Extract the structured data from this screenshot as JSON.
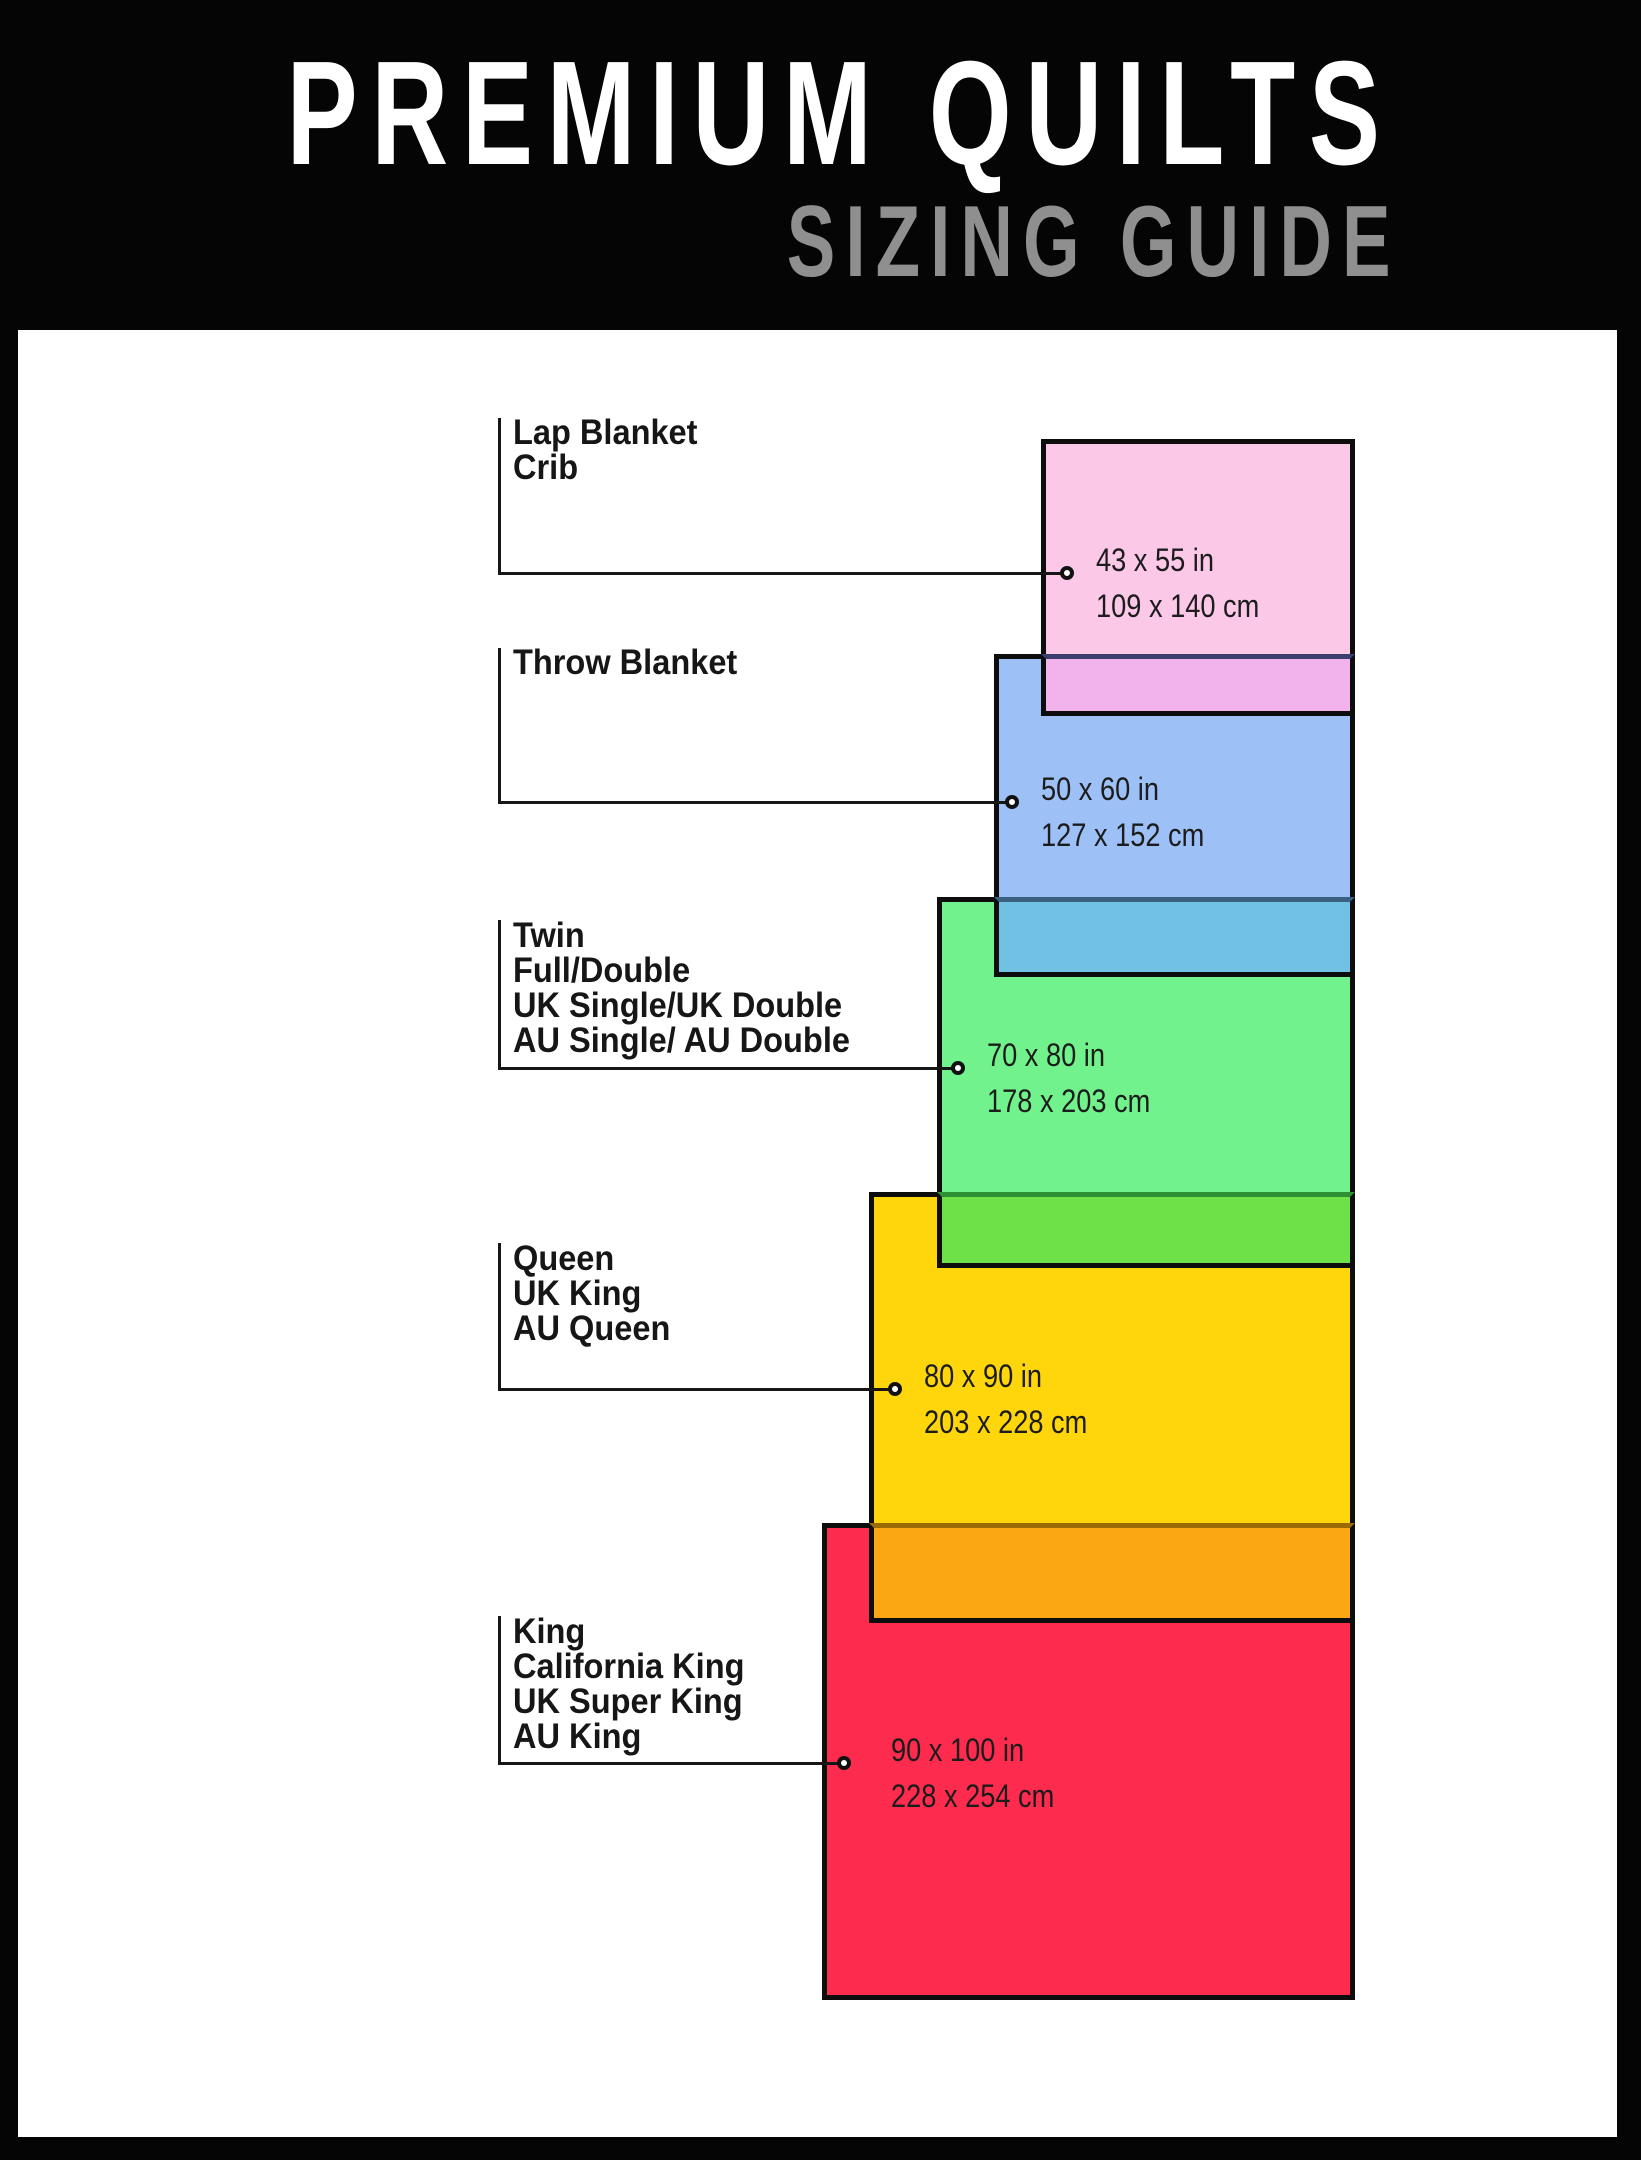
{
  "header": {
    "title": "PREMIUM QUILTS",
    "subtitle": "SIZING GUIDE",
    "background": "#050505",
    "title_color": "#ffffff",
    "subtitle_color": "#8f8f8f"
  },
  "canvas": {
    "background": "#ffffff",
    "border_color": "#0d0d0d",
    "connector_line_color": "#161616",
    "label_text_color": "#161616"
  },
  "sizes": [
    {
      "labels": [
        "Lap Blanket",
        "Crib"
      ],
      "inches": "43 x 55 in",
      "cm": "109 x 140 cm",
      "fill": "#fbc8e8",
      "overlap_fill": "#f2b2ec",
      "overlap_line": "#3a3f6e"
    },
    {
      "labels": [
        "Throw Blanket"
      ],
      "inches": "50 x 60 in",
      "cm": "127 x 152 cm",
      "fill": "#9dc1f7",
      "overlap_fill": "#70c1e4",
      "overlap_line": "#3b5f80"
    },
    {
      "labels": [
        "Twin",
        "Full/Double",
        "UK Single/UK Double",
        "AU Single/ AU Double"
      ],
      "inches": "70 x 80 in",
      "cm": "178 x 203 cm",
      "fill": "#72f28c",
      "overlap_fill": "#6fe148",
      "overlap_line": "#2f8f35"
    },
    {
      "labels": [
        "Queen",
        "UK King",
        "AU Queen"
      ],
      "inches": "80 x 90 in",
      "cm": "203 x 228 cm",
      "fill": "#ffd60b",
      "overlap_fill": "#fba713",
      "overlap_line": "#9a6a06"
    },
    {
      "labels": [
        "King",
        "California King",
        "UK Super King",
        "AU King"
      ],
      "inches": "90 x 100 in",
      "cm": "228 x 254 cm",
      "fill": "#fd2b4d",
      "overlap_fill": null,
      "overlap_line": null
    }
  ]
}
